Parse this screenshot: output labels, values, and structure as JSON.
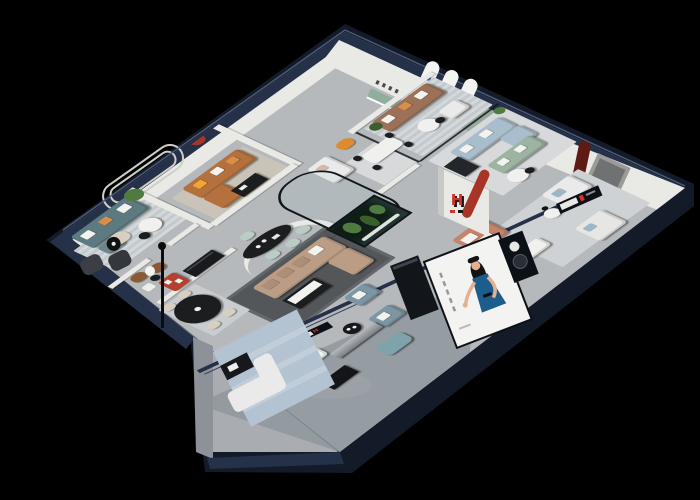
{
  "scene": {
    "type": "isometric-cutaway-furniture-showroom-render",
    "background": "#000000"
  },
  "brand": {
    "logo_letter": "H"
  },
  "poster": {
    "subject": "woman-in-blue-dress-advertising-banner"
  },
  "signs": {
    "storefront_sign_count": 2,
    "arch_poster_count": 3
  },
  "colors": {
    "bg": "#000000",
    "outer_navy": "#253049",
    "outer_navy_dark": "#131a28",
    "floor_main": "#b6b9bc",
    "floor_annex": "#a9adb1",
    "floor_walkway": "#8f969d",
    "wall_white": "#e9e9e6",
    "wall_groove": "#cfcfca",
    "sage_wall": "#94a99b",
    "arch_white": "#f2f4f1",
    "arch_mark": "#3a6ea8",
    "panel_grey": "#9b9b99",
    "niche_green": "#8fae9c",
    "accent_red": "#a63528",
    "accent_darkred": "#5f1a14",
    "shelf_red": "#b5402f",
    "pillar_grey": "#8d9299",
    "rug_beige": "#cac3b8",
    "rug_dark": "#54575a",
    "rug_blue": "#b4c3d1",
    "stripe_light": "#d3d8da",
    "stripe_dark": "#c3c9cc",
    "sofa_teal": "#5c7a80",
    "sofa_cognac": "#b4703d",
    "sofa_cognac2": "#8a5a36",
    "sofa_brown": "#9b7157",
    "sofa_tan": "#bb9d86",
    "sofa_sage": "#9cb4a1",
    "sofa_lightblue": "#a9becd",
    "sofa_bluegrey": "#7c96a3",
    "sofa_white": "#e9eae9",
    "sofa_cream": "#d8cfc0",
    "chair_orange": "#e08a2e",
    "chair_mint": "#b9cdc4",
    "ottoman": "#7fa3ab",
    "table_black": "#1c1d1f",
    "table_white": "#f0f0ee",
    "wood_dark": "#17181b",
    "plant": "#4f7c3e",
    "plant_dark": "#39602c",
    "bed_terra": "#c4836a",
    "poster_bg": "#f3f3f1",
    "dress_blue": "#1d5d8c",
    "skin": "#e5b092",
    "hair": "#141414",
    "logo_red": "#d0342c",
    "logo_black": "#141414",
    "sign_dark": "#0d1117",
    "glass_frame": "#10151c",
    "metal_light": "#b7bbbf",
    "metal_dark": "#7c8086",
    "pillow_white": "#f2f2ef",
    "pillow_orange": "#d98e4a",
    "pillow_yellow": "#f0a732",
    "pillow_blue": "#9db6c8",
    "pillow_blush": "#d8b8a8"
  }
}
